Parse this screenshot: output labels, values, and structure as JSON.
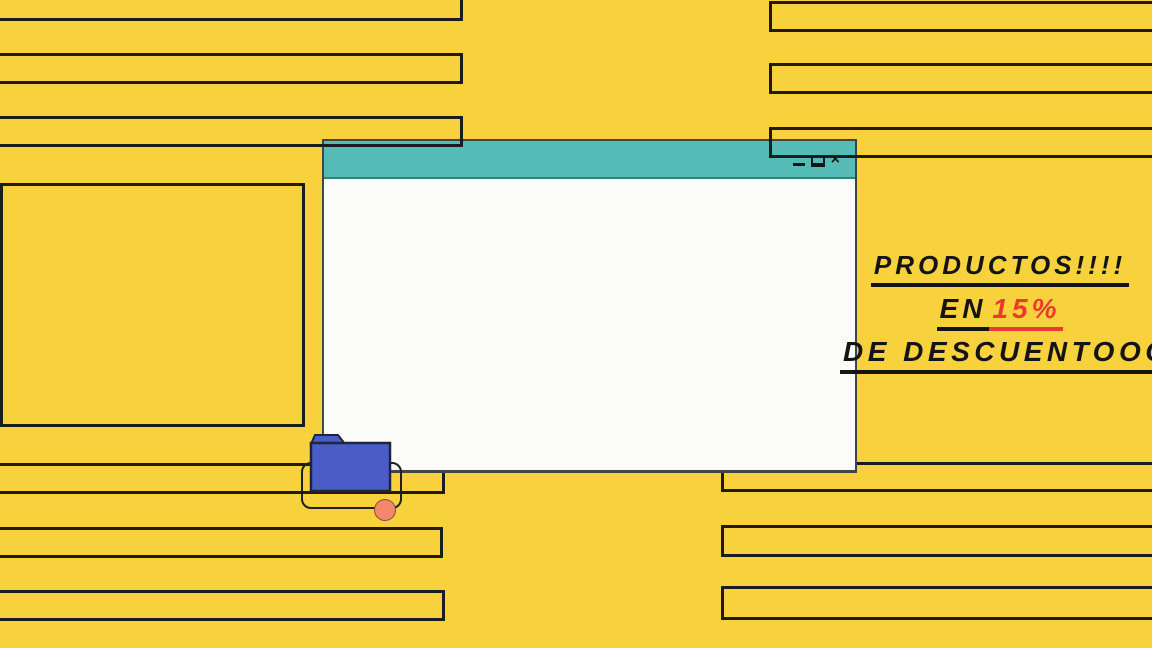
{
  "promo": {
    "line1": "PRODUCTOS!!!!",
    "line2_prefix": "EN",
    "line2_discount": "15%",
    "line3": "DE DESCUENTOOO",
    "text_color": "#141414",
    "discount_color": "#EF392E"
  },
  "window": {
    "title": "",
    "controls": {
      "minimize_icon": "minimize-icon",
      "maximize_icon": "maximize-icon",
      "close_icon": "close-icon",
      "close_glyph": "×"
    },
    "titlebar_color": "#55BBB7",
    "body_color": "#FBFBF9"
  },
  "icons": {
    "folder": "folder-icon",
    "dot": "orange-dot"
  },
  "colors": {
    "background_yellow": "#F8D23C",
    "stripe_outline": "#1c1c1c",
    "titlebar_teal": "#55BBB7",
    "window_white": "#FBFBF9",
    "folder_blue": "#4A5CC6",
    "dot_orange": "#F6876B",
    "accent_red": "#EF392E"
  }
}
